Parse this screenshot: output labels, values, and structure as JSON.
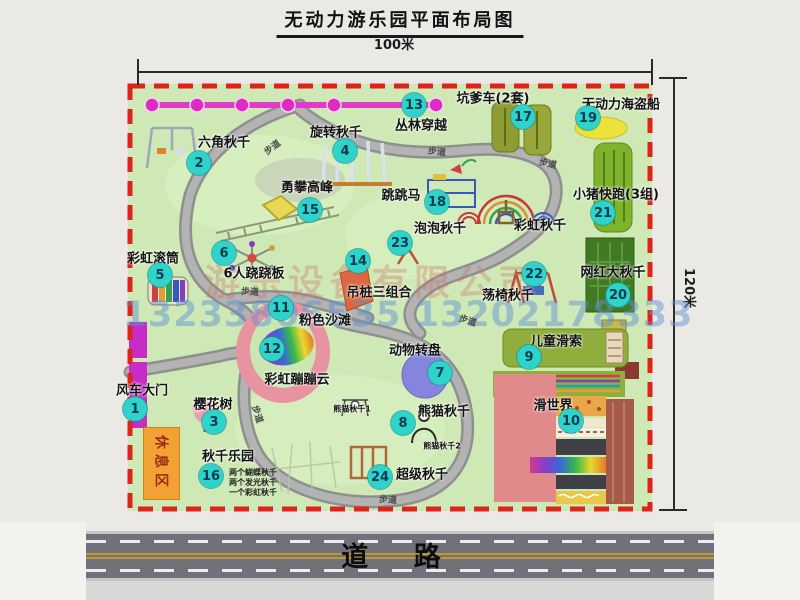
{
  "title": "无动力游乐园平面布局图",
  "dimensions": {
    "width": "100米",
    "height": "120米"
  },
  "watermark": {
    "company": "游乐设备有限公司",
    "phones": "13233806535 13202178333"
  },
  "road_label": "道 路",
  "rest_area": "休息区",
  "trail_label": "步道",
  "map": {
    "attractions": [
      {
        "num": "1",
        "label": "风车大门",
        "bx": 135,
        "by": 409,
        "lx": 142,
        "ly": 389
      },
      {
        "num": "2",
        "label": "六角秋千",
        "bx": 199,
        "by": 163,
        "lx": 224,
        "ly": 141
      },
      {
        "num": "3",
        "label": "樱花树",
        "bx": 214,
        "by": 422,
        "lx": 213,
        "ly": 403
      },
      {
        "num": "4",
        "label": "旋转秋千",
        "bx": 345,
        "by": 151,
        "lx": 336,
        "ly": 131
      },
      {
        "num": "5",
        "label": "彩虹滚筒",
        "bx": 160,
        "by": 275,
        "lx": 153,
        "ly": 257
      },
      {
        "num": "6",
        "label": "6人跷跷板",
        "bx": 224,
        "by": 253,
        "lx": 254,
        "ly": 272
      },
      {
        "num": "7",
        "label": "动物转盘",
        "bx": 440,
        "by": 373,
        "lx": 415,
        "ly": 349
      },
      {
        "num": "8",
        "label": "熊猫秋千",
        "bx": 403,
        "by": 423,
        "lx": 444,
        "ly": 410
      },
      {
        "num": "9",
        "label": "儿童滑索",
        "bx": 529,
        "by": 357,
        "lx": 556,
        "ly": 340
      },
      {
        "num": "10",
        "label": "滑世界",
        "bx": 571,
        "by": 421,
        "lx": 553,
        "ly": 404
      },
      {
        "num": "11",
        "label": "粉色沙滩",
        "bx": 281,
        "by": 308,
        "lx": 325,
        "ly": 319
      },
      {
        "num": "12",
        "label": "彩虹蹦蹦云",
        "bx": 272,
        "by": 349,
        "lx": 297,
        "ly": 378
      },
      {
        "num": "13",
        "label": "丛林穿越",
        "bx": 414,
        "by": 105,
        "lx": 421,
        "ly": 124
      },
      {
        "num": "14",
        "label": "吊桩三组合",
        "bx": 358,
        "by": 261,
        "lx": 379,
        "ly": 291
      },
      {
        "num": "15",
        "label": "勇攀高峰",
        "bx": 310,
        "by": 210,
        "lx": 307,
        "ly": 186
      },
      {
        "num": "16",
        "label": "秋千乐园",
        "bx": 211,
        "by": 476,
        "lx": 228,
        "ly": 455
      },
      {
        "num": "17",
        "label": "坑爹车(2套)",
        "bx": 523,
        "by": 117,
        "lx": 493,
        "ly": 97
      },
      {
        "num": "18",
        "label": "跳跳马",
        "bx": 437,
        "by": 202,
        "lx": 401,
        "ly": 194
      },
      {
        "num": "19",
        "label": "无动力海盗船",
        "bx": 588,
        "by": 118,
        "lx": 621,
        "ly": 103
      },
      {
        "num": "20",
        "label": "网红大秋千",
        "bx": 618,
        "by": 295,
        "lx": 613,
        "ly": 271
      },
      {
        "num": "21",
        "label": "小猪快跑(3组)",
        "bx": 603,
        "by": 213,
        "lx": 616,
        "ly": 193
      },
      {
        "num": "22",
        "label": "荡椅秋千",
        "bx": 534,
        "by": 274,
        "lx": 508,
        "ly": 294
      },
      {
        "num": "23",
        "label": "泡泡秋千",
        "bx": 400,
        "by": 243,
        "lx": 440,
        "ly": 227
      },
      {
        "num": "24",
        "label": "超级秋千",
        "bx": 380,
        "by": 477,
        "lx": 422,
        "ly": 473
      },
      {
        "num": null,
        "label": "彩虹秋千",
        "bx": null,
        "by": null,
        "lx": 540,
        "ly": 224
      }
    ],
    "small_labels": [
      {
        "label": "熊猫秋千1",
        "x": 352,
        "y": 409
      },
      {
        "label": "熊猫秋千2",
        "x": 442,
        "y": 446
      }
    ],
    "swing_park_notes": [
      "两个蝴蝶秋千",
      "两个发光秋千",
      "一个彩虹秋千"
    ],
    "trail_labels": [
      {
        "x": 272,
        "y": 147,
        "r": -38
      },
      {
        "x": 437,
        "y": 151,
        "r": 6
      },
      {
        "x": 548,
        "y": 163,
        "r": 12
      },
      {
        "x": 250,
        "y": 291,
        "r": 4
      },
      {
        "x": 468,
        "y": 320,
        "r": 18
      },
      {
        "x": 258,
        "y": 414,
        "r": 72
      },
      {
        "x": 388,
        "y": 499,
        "r": 4
      }
    ]
  }
}
